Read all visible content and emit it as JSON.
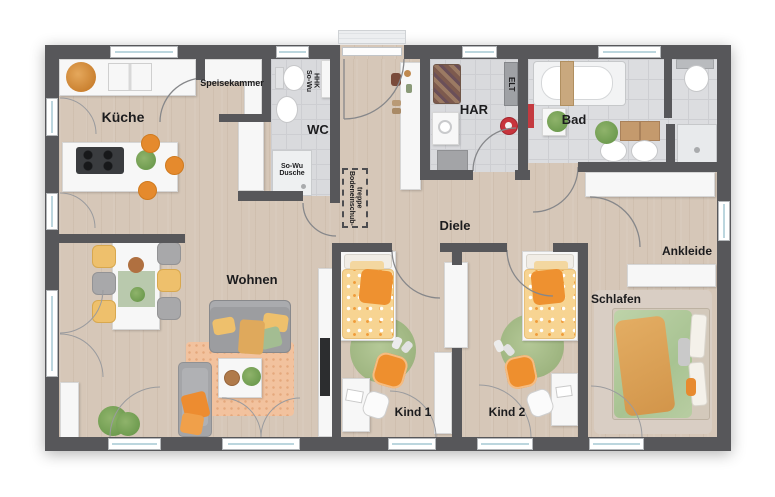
{
  "plan": {
    "rooms": {
      "kueche": "Küche",
      "speisekammer": "Speisekammer",
      "wc": "WC",
      "har": "HAR",
      "bad": "Bad",
      "diele": "Diele",
      "wohnen": "Wohnen",
      "kind1": "Kind 1",
      "kind2": "Kind 2",
      "schlafen": "Schlafen",
      "ankleide": "Ankleide"
    },
    "annotations": {
      "so_wu_hhk": "So-Wu\nHHK",
      "so_wu_dusche": "So-Wu\nDusche",
      "elt": "ELT",
      "bodeneinschubtreppe": "Bodeneinschub-\ntreppe"
    },
    "colors": {
      "wall": "#57575a",
      "wood_floor": "#d6c7b8",
      "tile_floor": "#d9dadd",
      "accent_orange": "#ee8f2f",
      "accent_yellow": "#eec06c",
      "accent_green": "#a9bf8d",
      "furniture_white": "#f7f7f7"
    }
  }
}
